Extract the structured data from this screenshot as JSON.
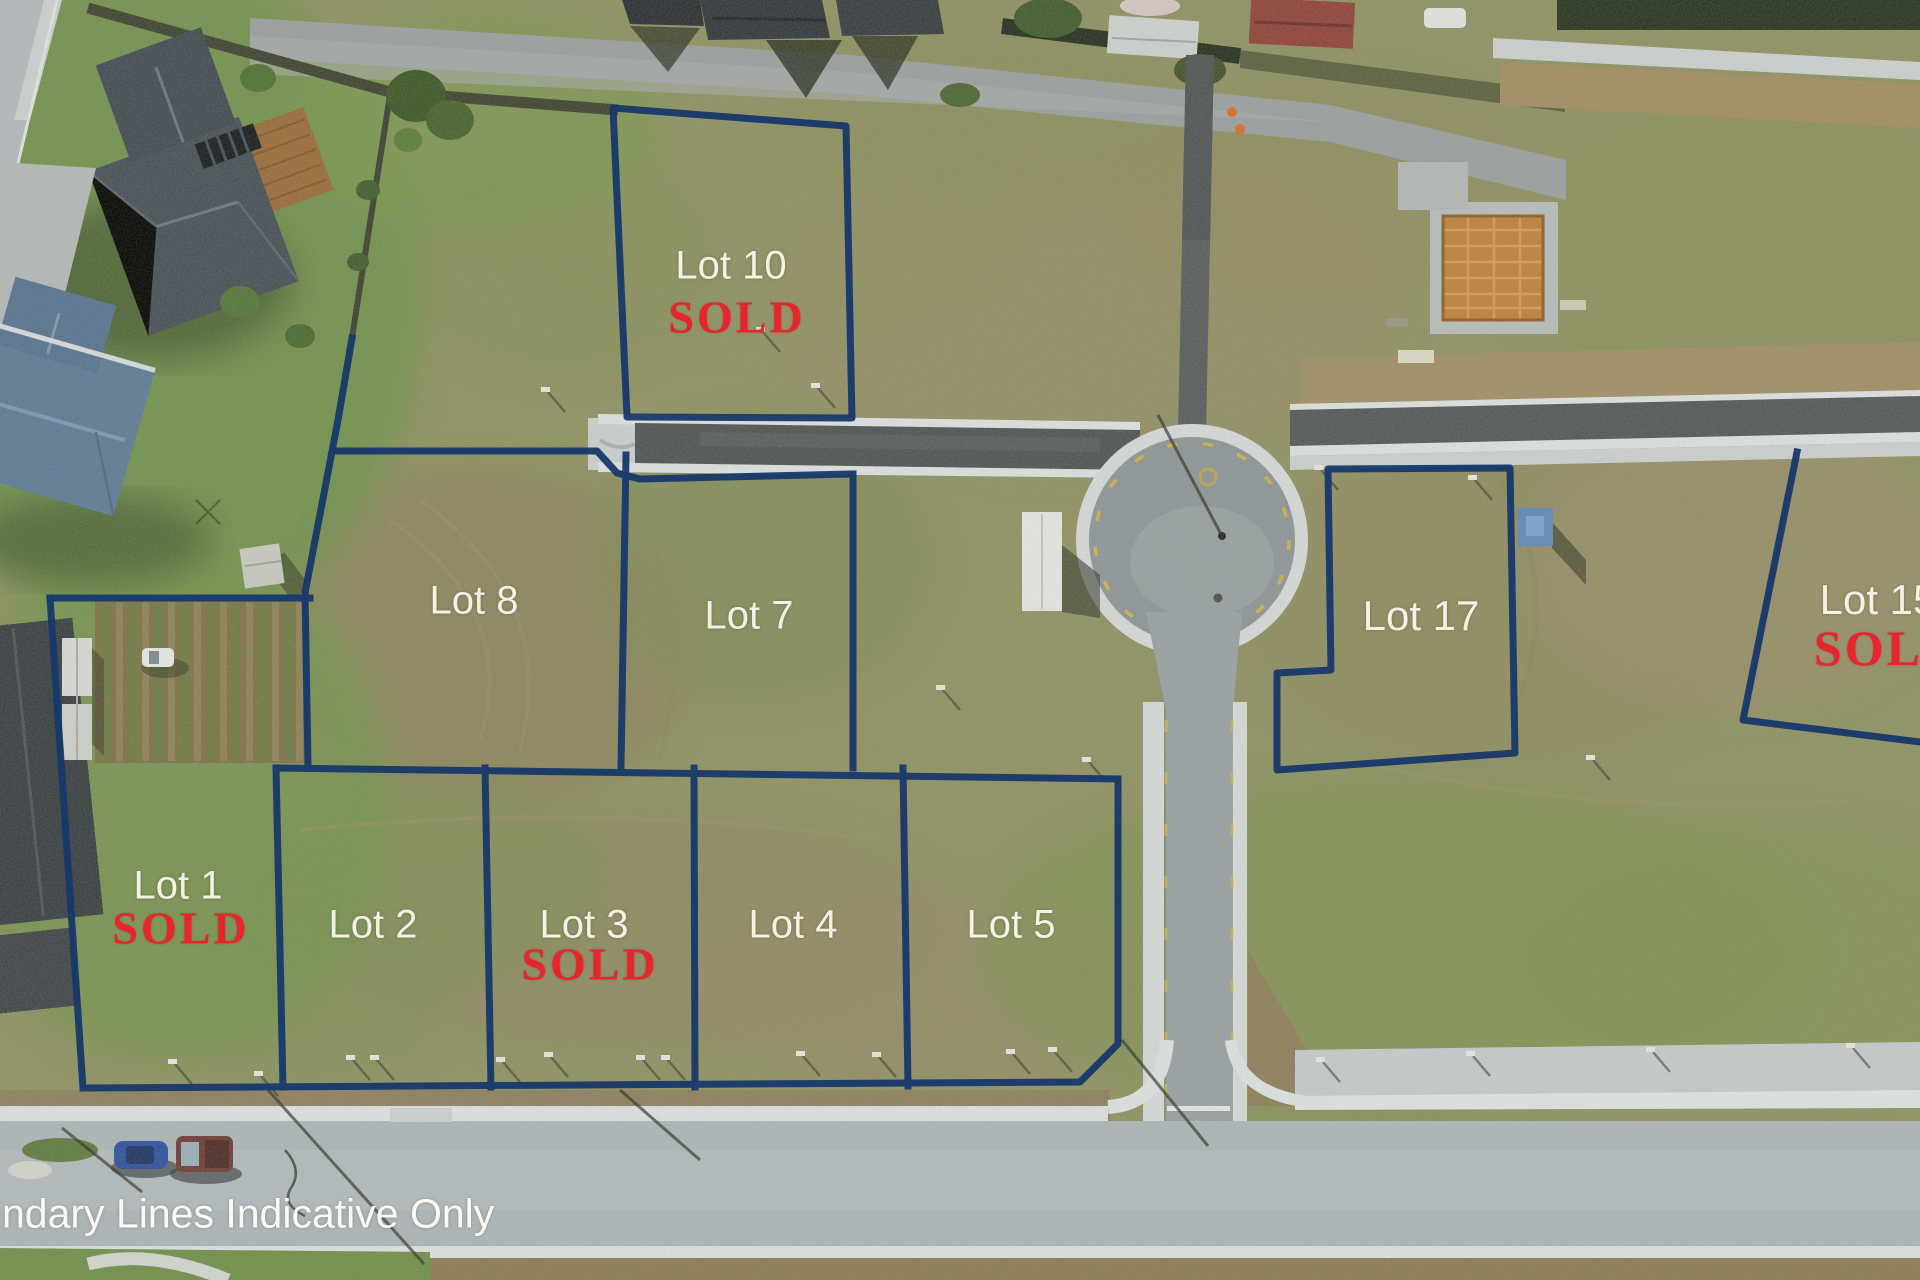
{
  "scene": {
    "type": "aerial drone photo of a residential subdivision with lot boundary overlay",
    "disclaimer": "ndary Lines Indicative Only"
  },
  "sold_text": "SOLD",
  "lots": {
    "lot1": {
      "label": "Lot 1",
      "sold": true
    },
    "lot2": {
      "label": "Lot 2",
      "sold": false
    },
    "lot3": {
      "label": "Lot 3",
      "sold": true
    },
    "lot4": {
      "label": "Lot 4",
      "sold": false
    },
    "lot5": {
      "label": "Lot 5",
      "sold": false
    },
    "lot7": {
      "label": "Lot 7",
      "sold": false
    },
    "lot8": {
      "label": "Lot 8",
      "sold": false
    },
    "lot10": {
      "label": "Lot 10",
      "sold": true
    },
    "lot15": {
      "label": "Lot 15",
      "sold": true
    },
    "lot17": {
      "label": "Lot 17",
      "sold": false
    }
  },
  "colors": {
    "boundary_line": "#17386b",
    "lot_label_text": "#f5f1e3",
    "sold_text_color": "#e8242c",
    "new_asphalt": "#4d5155",
    "concrete_road": "#aab2b9",
    "kerb_white": "#dfe3e6"
  }
}
